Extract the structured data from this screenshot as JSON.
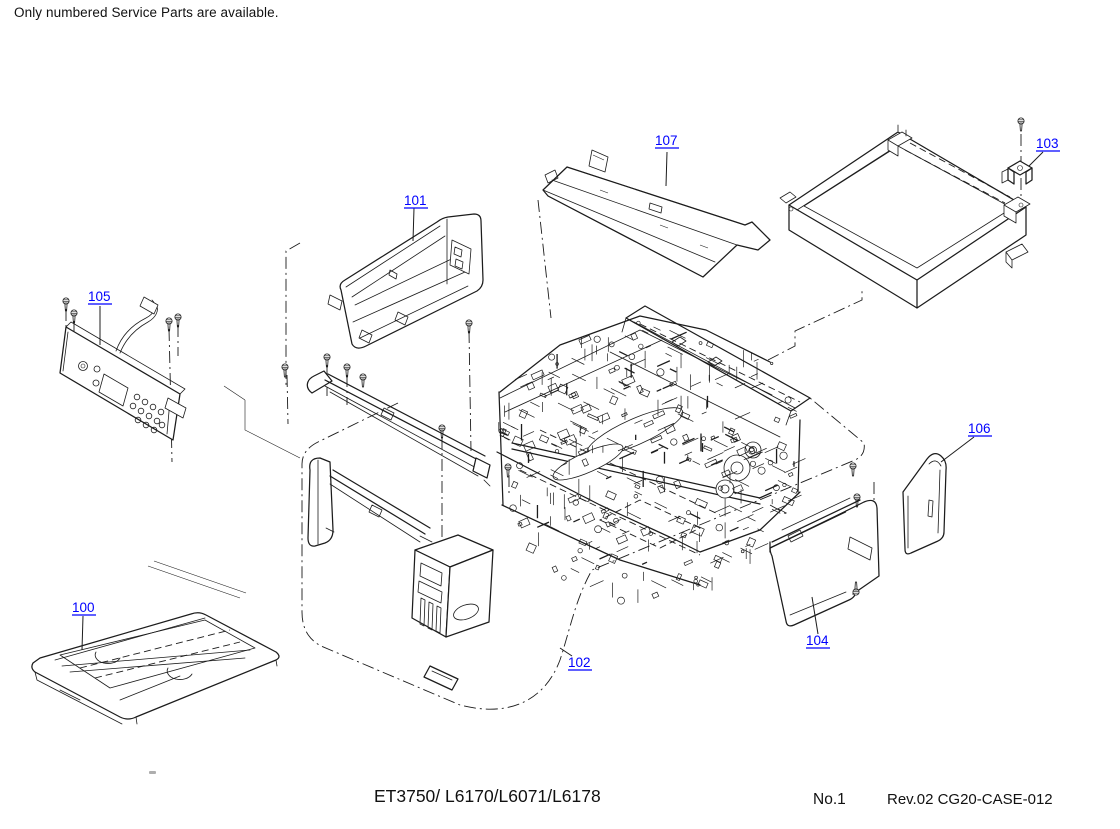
{
  "note": "Only numbered Service Parts are available.",
  "footer": {
    "model": "ET3750/ L6170/L6071/L6178",
    "sheet_no": "No.1",
    "revision": "Rev.02 CG20-CASE-012"
  },
  "diagram": {
    "type": "exploded-parts-diagram",
    "subject": "printer casing service parts",
    "colors": {
      "part_label": "#0000FF",
      "line_art": "#1c1c1c",
      "background": "#ffffff"
    },
    "parts": [
      {
        "number": "100"
      },
      {
        "number": "101"
      },
      {
        "number": "102"
      },
      {
        "number": "103"
      },
      {
        "number": "104"
      },
      {
        "number": "105"
      },
      {
        "number": "106"
      },
      {
        "number": "107"
      }
    ]
  }
}
